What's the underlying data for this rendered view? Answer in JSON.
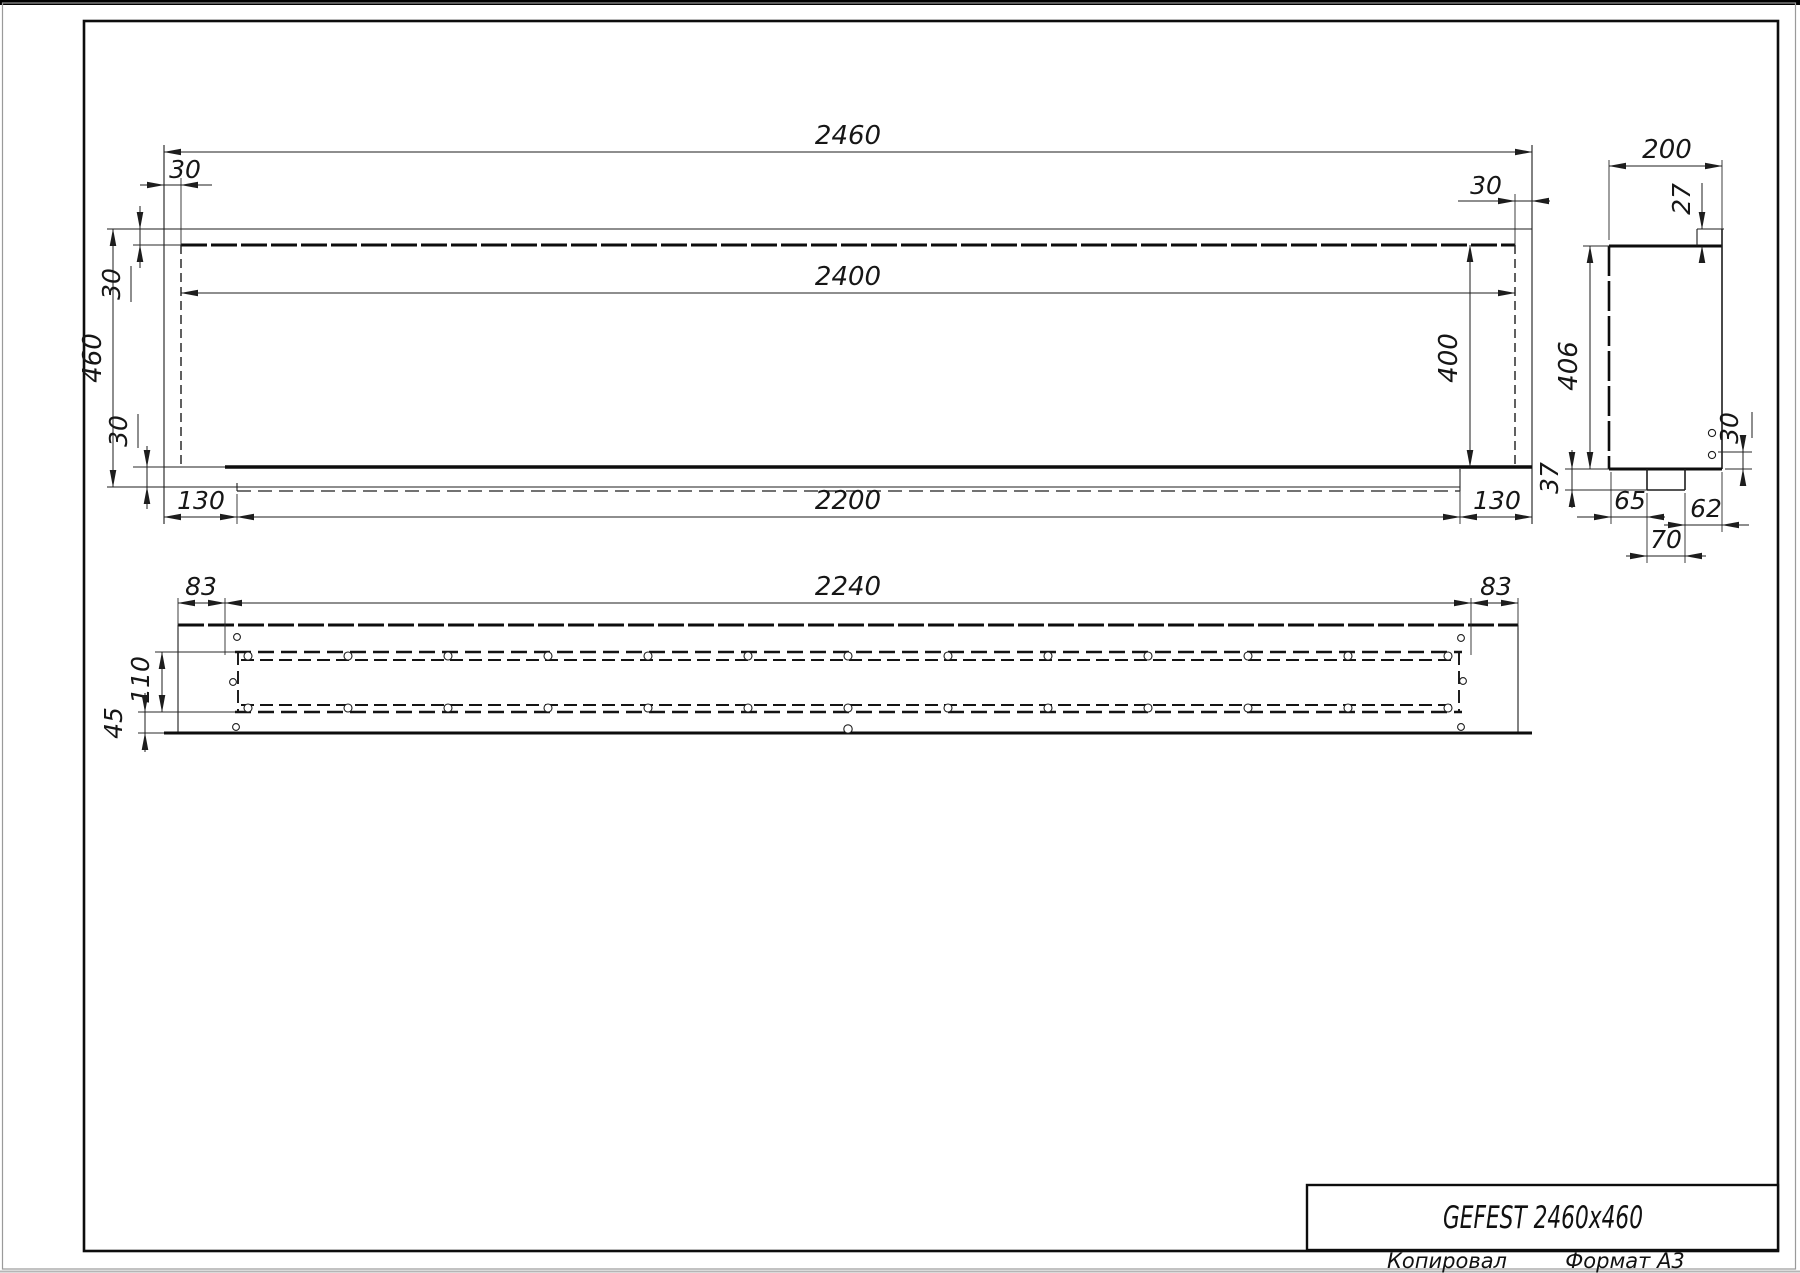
{
  "title_block": {
    "product": "GEFEST 2460x460",
    "copied_label": "Копировал",
    "format_label": "Формат А3"
  },
  "front_view": {
    "width_total": "2460",
    "flange_top_left": "30",
    "width_inner": "2400",
    "flange_top_right": "30",
    "height_total": "460",
    "flange_upper": "30",
    "flange_lower": "30",
    "opening_height": "400",
    "bottom_left_offset": "130",
    "bottom_width": "2200",
    "bottom_right_offset": "130"
  },
  "side_view": {
    "depth": "200",
    "front_lip": "27",
    "body_height": "406",
    "foot_height": "37",
    "hole_offset": "30",
    "foot_left_offset": "65",
    "foot_right_offset": "62",
    "foot_width": "70"
  },
  "top_view": {
    "side_margin_left": "83",
    "slot_length": "2240",
    "side_margin_right": "83",
    "slot_width": "110",
    "front_margin": "45"
  }
}
